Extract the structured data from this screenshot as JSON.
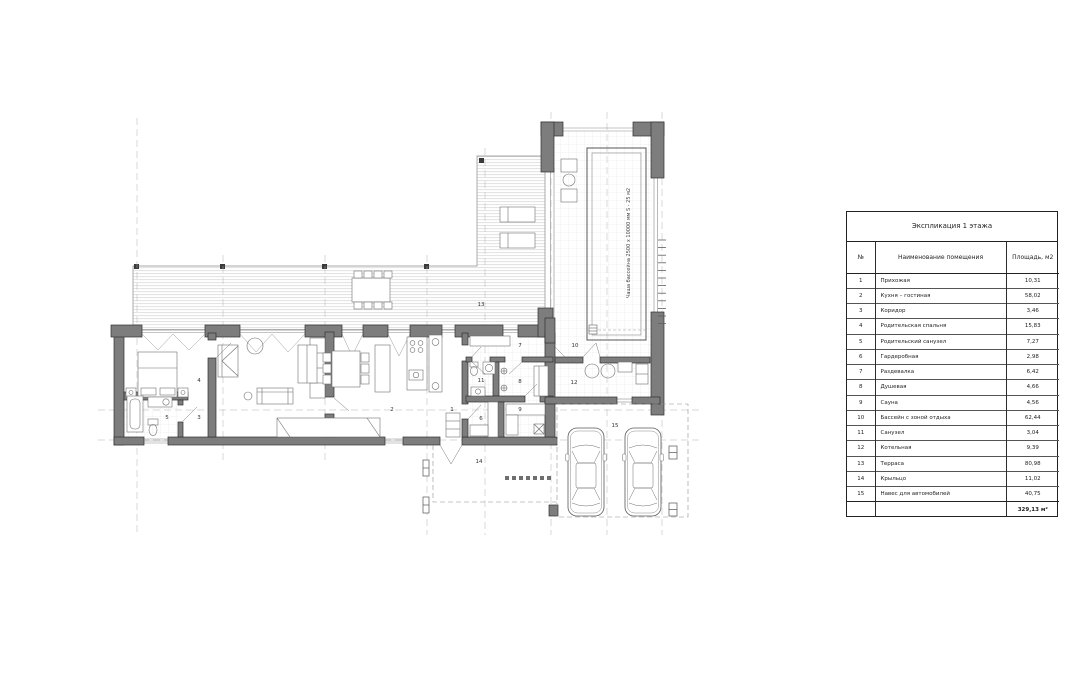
{
  "table": {
    "title": "Экспликация 1 этажа",
    "columns": [
      "№",
      "Наименование помещения",
      "Площадь, м2"
    ],
    "rows": [
      [
        "1",
        "Прихожая",
        "10,31"
      ],
      [
        "2",
        "Кухня – гостиная",
        "58,02"
      ],
      [
        "3",
        "Коридор",
        "3,46"
      ],
      [
        "4",
        "Родительская спальня",
        "15,83"
      ],
      [
        "5",
        "Родительский санузел",
        "7,27"
      ],
      [
        "6",
        "Гардеробная",
        "2,98"
      ],
      [
        "7",
        "Раздевалка",
        "6,42"
      ],
      [
        "8",
        "Душевая",
        "4,66"
      ],
      [
        "9",
        "Сауна",
        "4,56"
      ],
      [
        "10",
        "Бассейн с зоной отдыха",
        "62,44"
      ],
      [
        "11",
        "Санузел",
        "3,04"
      ],
      [
        "12",
        "Котельная",
        "9,39"
      ],
      [
        "13",
        "Терраса",
        "80,98"
      ],
      [
        "14",
        "Крыльцо",
        "11,02"
      ],
      [
        "15",
        "Навес для автомобилей",
        "40,75"
      ]
    ],
    "total": "329,13 м²"
  },
  "plan": {
    "pool_label": "Чаша бассейна 2500 х 10000 мм  S - 25 м2",
    "room_numbers": [
      "1",
      "2",
      "3",
      "4",
      "5",
      "6",
      "7",
      "8",
      "9",
      "10",
      "11",
      "12",
      "13",
      "14",
      "15"
    ]
  },
  "colors": {
    "wall_fill": "#7d7d7d",
    "line": "#2f2f2f",
    "axis": "#b5b5b5",
    "deck_stripe": "#e1e1e1",
    "tile_grid": "#e6e6e6",
    "text": "#1f1f1f"
  }
}
